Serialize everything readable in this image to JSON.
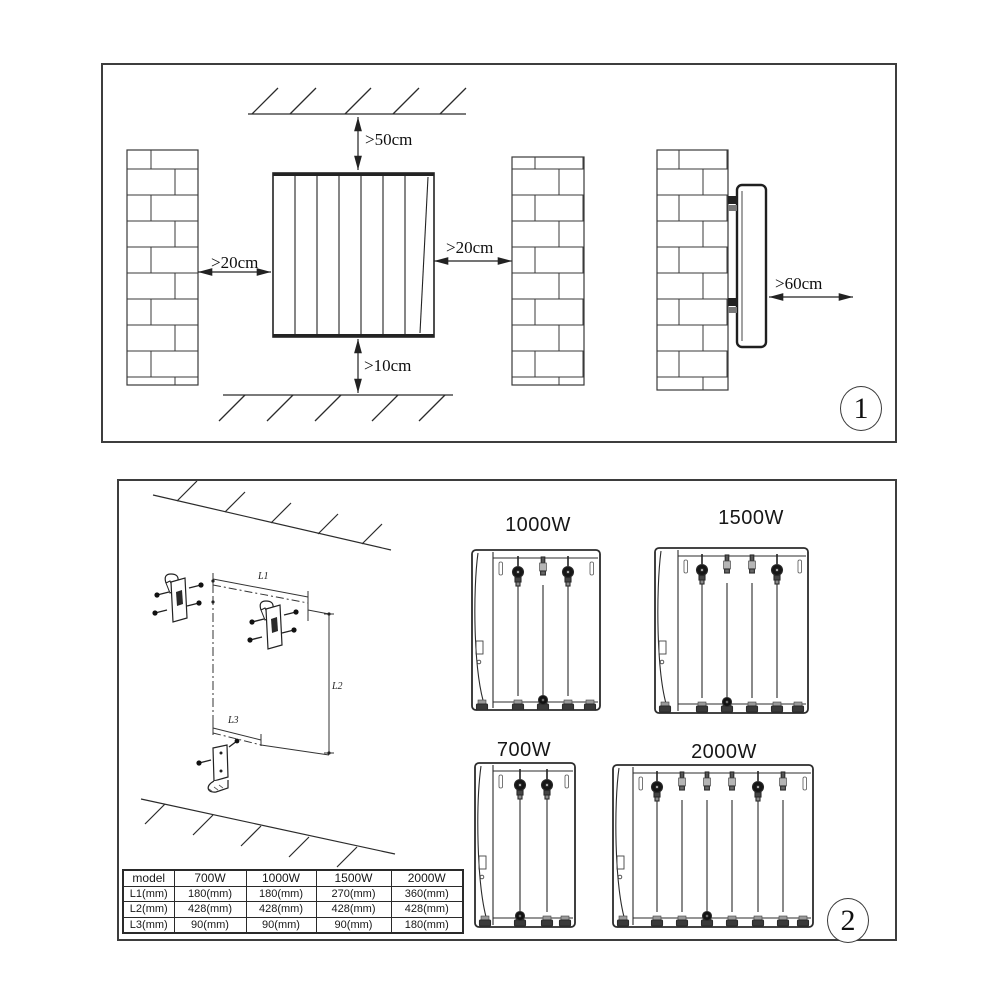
{
  "doc": {
    "background": "#ffffff",
    "line_color": "#2b2b2b"
  },
  "panel1": {
    "number": "1",
    "clearances": {
      "top": ">50cm",
      "left": ">20cm",
      "right": ">20cm",
      "bottom": ">10cm",
      "front": ">60cm"
    }
  },
  "panel2": {
    "number": "2",
    "dims": {
      "l1": "L1",
      "l2": "L2",
      "l3": "L3"
    },
    "models": [
      {
        "label": "1000W"
      },
      {
        "label": "1500W"
      },
      {
        "label": "700W"
      },
      {
        "label": "2000W"
      }
    ],
    "table": {
      "headers": [
        "model",
        "700W",
        "1000W",
        "1500W",
        "2000W"
      ],
      "rows": [
        {
          "label": "L1(mm)",
          "values": [
            "180(mm)",
            "180(mm)",
            "270(mm)",
            "360(mm)"
          ]
        },
        {
          "label": "L2(mm)",
          "values": [
            "428(mm)",
            "428(mm)",
            "428(mm)",
            "428(mm)"
          ]
        },
        {
          "label": "L3(mm)",
          "values": [
            "90(mm)",
            "90(mm)",
            "90(mm)",
            "180(mm)"
          ]
        }
      ]
    }
  }
}
